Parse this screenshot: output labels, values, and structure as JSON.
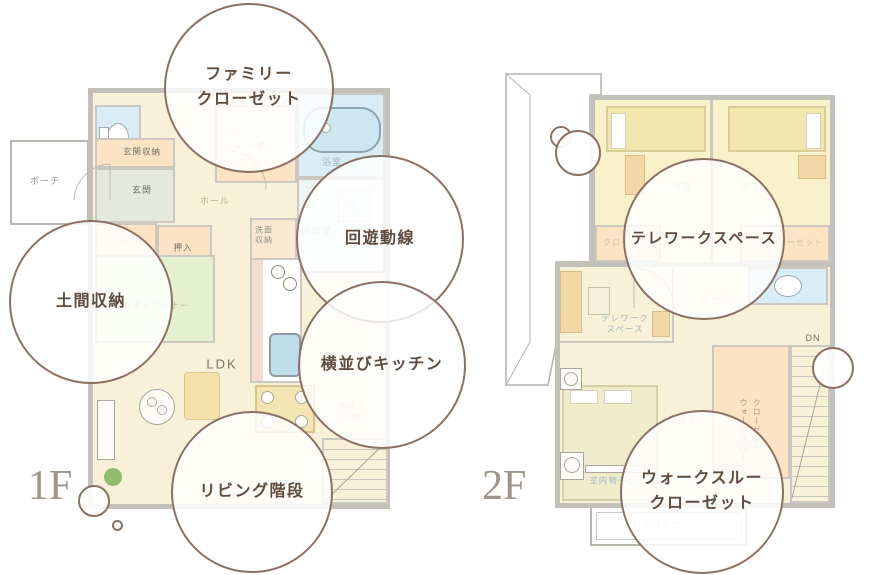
{
  "colors": {
    "circle_border": "#8b7164",
    "circle_text": "#5f4c3e",
    "floor_label": "#9d948a",
    "wall_gray": "#c3c0ba",
    "floor_cream": "#f8f1d8",
    "tatami_green": "#e5f0cf",
    "water_blue": "#d8edf5",
    "storage_orange": "#fbe3c4"
  },
  "floor1": {
    "label": "1F",
    "rooms": {
      "porch": "ポーチ",
      "entrance_storage": "玄関収納",
      "entrance": "玄関",
      "hall": "ホール",
      "family_closet_line1": "ファミリー",
      "family_closet_line2": "クローゼット",
      "bath": "浴室",
      "washroom": "洗面室",
      "wash_storage_line1": "洗面",
      "wash_storage_line2": "収納",
      "s_mark": "S",
      "oshiire": "押入",
      "doma": "土間収納",
      "tatami": "タタミコーナー",
      "ldk": "LDK",
      "understair_line1": "階段下",
      "understair_line2": "収納"
    }
  },
  "floor2": {
    "label": "2F",
    "rooms": {
      "bedroom_left": "洋室",
      "bedroom_right": "洋室",
      "closet_left": "クローゼット",
      "closet_right": "クローゼット",
      "hall": "ホール",
      "telework_line1": "テレワーク",
      "telework_line2": "スペース",
      "main_bedroom": "主寝室",
      "indoor_drying": "室内物干し",
      "walkthrough_line1": "ウォークスルー",
      "walkthrough_line2": "クローゼット",
      "down": "DN",
      "balcony": "バルコニー"
    }
  },
  "callouts": {
    "family_closet_line1": "ファミリー",
    "family_closet_line2": "クローゼット",
    "circulation": "回遊動線",
    "doma_storage": "土間収納",
    "side_by_side_kitchen": "横並びキッチン",
    "living_stairs": "リビング階段",
    "telework_space": "テレワークスペース",
    "walkthrough_line1": "ウォークスルー",
    "walkthrough_line2": "クローゼット"
  }
}
